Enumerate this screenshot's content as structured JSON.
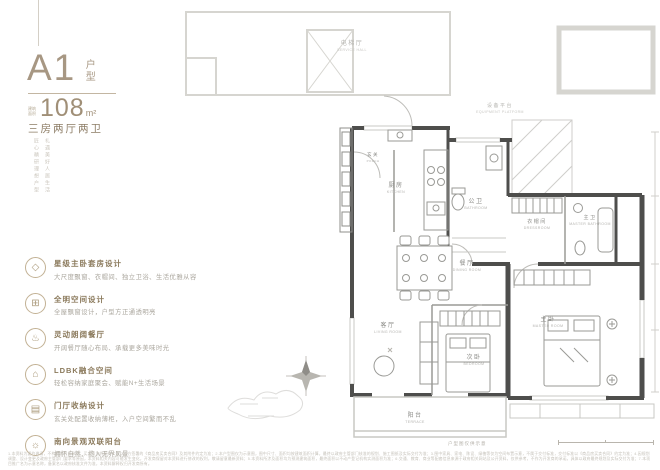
{
  "meta": {
    "accent_gold": "#a79783",
    "feature_title_color": "#8b7a5c",
    "wall_dark": "#4e4e4c",
    "line_light": "#d6d5d0"
  },
  "header": {
    "plan_code": "A1",
    "plan_type": "户型",
    "area_label": "建筑面积",
    "area_value": "108",
    "area_unit": "m²",
    "rooms_summary": "三房两厅两卫",
    "tagline_col1": "匠心精研理想户型",
    "tagline_col2": "礼遇美好人居生活"
  },
  "features": [
    {
      "icon": "gem-icon",
      "glyph": "◇",
      "title": "星级主卧套房设计",
      "desc": "大尺度飘窗、衣帽间、独立卫浴、生活优雅从容"
    },
    {
      "icon": "grid-icon",
      "glyph": "⊞",
      "title": "全明空间设计",
      "desc": "全屋飘窗设计，户型方正通透明亮"
    },
    {
      "icon": "dining-icon",
      "glyph": "♨",
      "title": "灵动朗阔餐厅",
      "desc": "开阔餐厅随心布局、承载更多美味时光"
    },
    {
      "icon": "home-icon",
      "glyph": "⌂",
      "title": "LDBK融合空间",
      "desc": "轻松容纳家庭聚会、赋能N+生活场景"
    },
    {
      "icon": "cabinet-icon",
      "glyph": "▤",
      "title": "门厅收纳设计",
      "desc": "玄关处配置收纳薄柜，入户空间繁而不乱"
    },
    {
      "icon": "sun-icon",
      "glyph": "☼",
      "title": "南向景观双联阳台",
      "desc": "拥怀自然、揽入无界风景"
    }
  ],
  "plan": {
    "rooms": {
      "service_hall": {
        "cn": "电梯厅",
        "en": "SERVICE HALL"
      },
      "equipment": {
        "cn": "设备平台",
        "en": "EQUIPMENT PLATFORM"
      },
      "porch": {
        "cn": "玄关",
        "en": "PORCH"
      },
      "kitchen": {
        "cn": "厨房",
        "en": "KITCHEN"
      },
      "bathroom": {
        "cn": "公卫",
        "en": "BATHROOM"
      },
      "dressroom": {
        "cn": "衣帽间",
        "en": "DRESSROOM"
      },
      "master_bathroom": {
        "cn": "主卫",
        "en": "MASTER BATHROOM"
      },
      "dining": {
        "cn": "餐厅",
        "en": "DINING ROOM"
      },
      "living": {
        "cn": "客厅",
        "en": "LIVING ROOM"
      },
      "bedroom": {
        "cn": "次卧",
        "en": "BEDROOM"
      },
      "master": {
        "cn": "主卧",
        "en": "MASTER ROOM"
      },
      "terrace": {
        "cn": "阳台",
        "en": "TERRACE"
      }
    },
    "caption": "户型图仅供示意"
  },
  "footer": {
    "disclaimer": "1.本资料为要约邀请，不构成要约或承诺，买卖双方的权利义务以双方签署的《商品房买卖合同》及其附件约定为准；2.本户型图仅为示意图，图中尺寸、面积均按建筑面积计算，最终以政府主管部门核准的规划、施工图纸及实际交付为准；3.图中家具、家电、陈设、绿植等仅为空间布置示意，不属于交付标准，交付标准以《商品房买卖合同》约定为准；4.因规划调整、设计变更及政府主管部门要求等原因，本资料相关内容可能发生变化，开发商保留对本资料进行修改的权利，敬请留意最新资料；5.本资料所涉及面积均为预测建筑面积，最终面积以不动产登记机构实测面积为准；6.交通、教育、商业等配套信息来源于政府相关网站及公开资料，仅供参考，不作为开发商的承诺，具体以政府最终规划及实际交付为准；7.本项目推广名为示意名称，备案名以政府核准文件为准，本资料解释权归开发商所有。"
  }
}
